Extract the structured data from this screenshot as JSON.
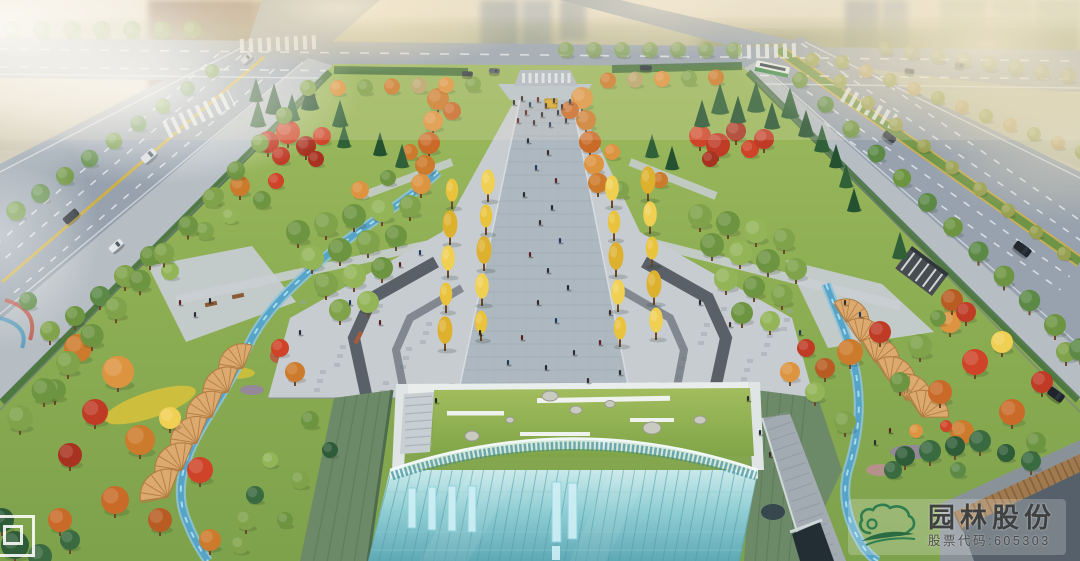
{
  "watermark": {
    "company_name": "园林股份",
    "stock_code_label": "股票代码:605303",
    "logo_icon": "cloud-leaf-logo",
    "name_color": "#3f4040",
    "accent_green": "#2e7d4f"
  },
  "scene": {
    "label": "autumn-park-plaza-aerial-rendering",
    "palette": {
      "haze": "#e8dfc9",
      "road_asphalt": "#9aa5b0",
      "sidewalk": "#b6bec4",
      "plaza_paving": "#c7ccd1",
      "promenade_paving": "#aeb8c0",
      "lawn_green": "#8aab55",
      "canopy_green": "#6d9440",
      "conifer_green": "#2c5634",
      "autumn_orange": "#cc7b2c",
      "autumn_red": "#bf3b26",
      "ginkgo_yellow": "#e9c33b",
      "stream_blue": "#56a4c8",
      "fan_canopy_tan": "#dcaa6e",
      "glass_roof_teal": "#8ecdd2",
      "metal_roof_green": "#6d8a68"
    }
  },
  "corner_mark": {
    "icon": "nested-squares-mark"
  }
}
